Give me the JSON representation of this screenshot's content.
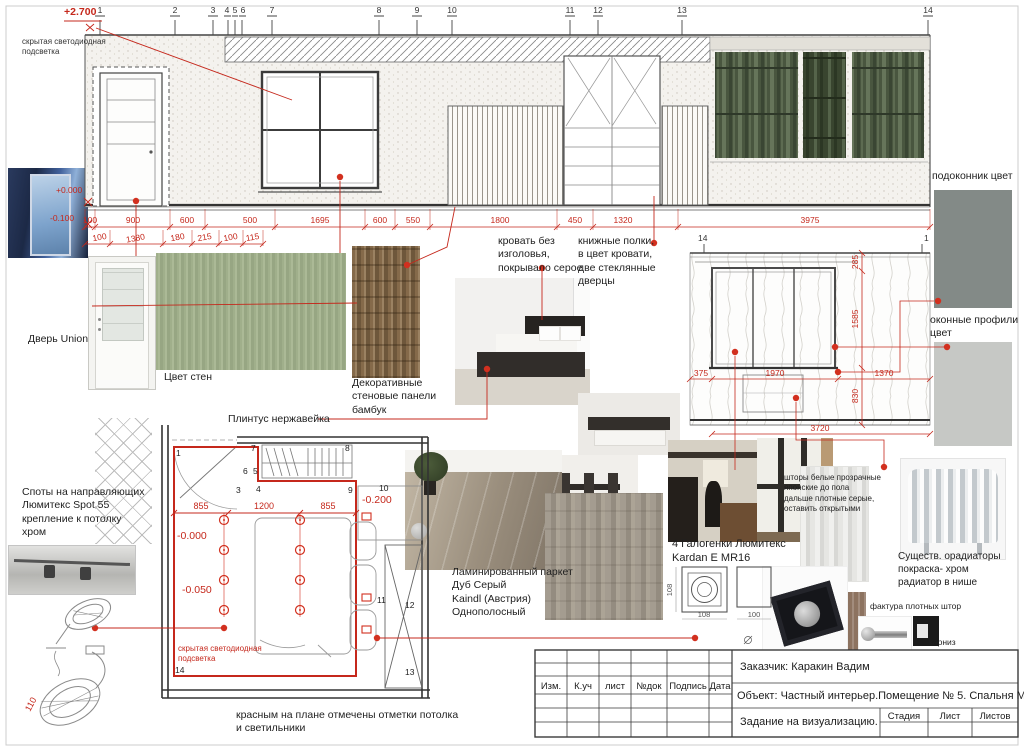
{
  "palette": {
    "red": "#c5281c",
    "ink": "#2f2f2f",
    "wall_green": "#a7b592",
    "sill_gray": "#838a87",
    "profile_gray": "#c6c8c5"
  },
  "levels": {
    "ceiling": "+2.700",
    "zero": "+0.000",
    "minus": "-0.100"
  },
  "grid_labels": [
    "1",
    "2",
    "3",
    "4",
    "5",
    "6",
    "7",
    "8",
    "9",
    "10",
    "11",
    "12",
    "13",
    "14"
  ],
  "dims": {
    "row1": [
      "100",
      "900",
      "600",
      "500",
      "1695",
      "600",
      "550",
      "1800",
      "450",
      "1320",
      "3975"
    ],
    "row2": [
      "100",
      "1380",
      "180",
      "215",
      "100",
      "115"
    ]
  },
  "window_wall": {
    "grid_left": "14",
    "grid_right": "1",
    "v_dims": [
      "285",
      "1585",
      "830"
    ],
    "h_dims": [
      "375",
      "1970",
      "1370"
    ],
    "total": "3720"
  },
  "plan": {
    "dims": [
      "855",
      "1200",
      "855"
    ],
    "level_0": "-0.000",
    "level_50": "-0.050",
    "level_200": "-0.200",
    "hidden_light": "скрытая светодиодная\nподсветка",
    "nodes": [
      "1",
      "3",
      "4",
      "5",
      "6",
      "7",
      "8",
      "9",
      "10",
      "11",
      "12",
      "13",
      "14"
    ],
    "lamp_dim": "110"
  },
  "fixture_dims": {
    "w": "108",
    "h": "100"
  },
  "notes": {
    "hidden_light_top": "скрытая светодиодная\nподсветка",
    "door": "Дверь Union",
    "wall_color": "Цвет стен",
    "bamboo": "Декоративные\nстеновые панели\nбамбук",
    "plinth": "Плинтус нержавейка",
    "bed": "кровать без\nизголовья,\nпокрывало серое",
    "shelves": "книжные полки,\nв цвет кровати,\nдве стеклянные\nдверцы",
    "spots": "Споты на направляющих\nЛюмитекс Spot 55\nкрепление к потолку\nхром",
    "laminate": "Ламинированный паркет\nДуб Серый\nKaindl (Австрия)\nОднополосный",
    "halogen": "4 Галогенки Люмитекс\nKardan E MR16",
    "curtains": "шторы белые прозрачные\nяпонские до пола\nдальше плотные серые,\nоставить открытыми",
    "radiators": "Существ. орадиаторы\nпокраска- хром\nрадиатор в нише",
    "fabric": "фактура плотных штор",
    "cornice": "карниз",
    "sill": "подоконник цвет",
    "profiles": "оконные профили\nцвет",
    "plan_note": "красным на плане отмечены отметки потолка\nи светильники"
  },
  "titleblock": {
    "client": "Заказчик: Каракин Вадим",
    "object": "Объект: Частный интерьер.Помещение № 5. Спальня М 1:40",
    "task": "Задание на визуализацию.",
    "cols": [
      "Изм.",
      "К.уч",
      "лист",
      "№док",
      "Подпись",
      "Дата"
    ],
    "stage": [
      "Стадия",
      "Лист",
      "Листов"
    ]
  }
}
